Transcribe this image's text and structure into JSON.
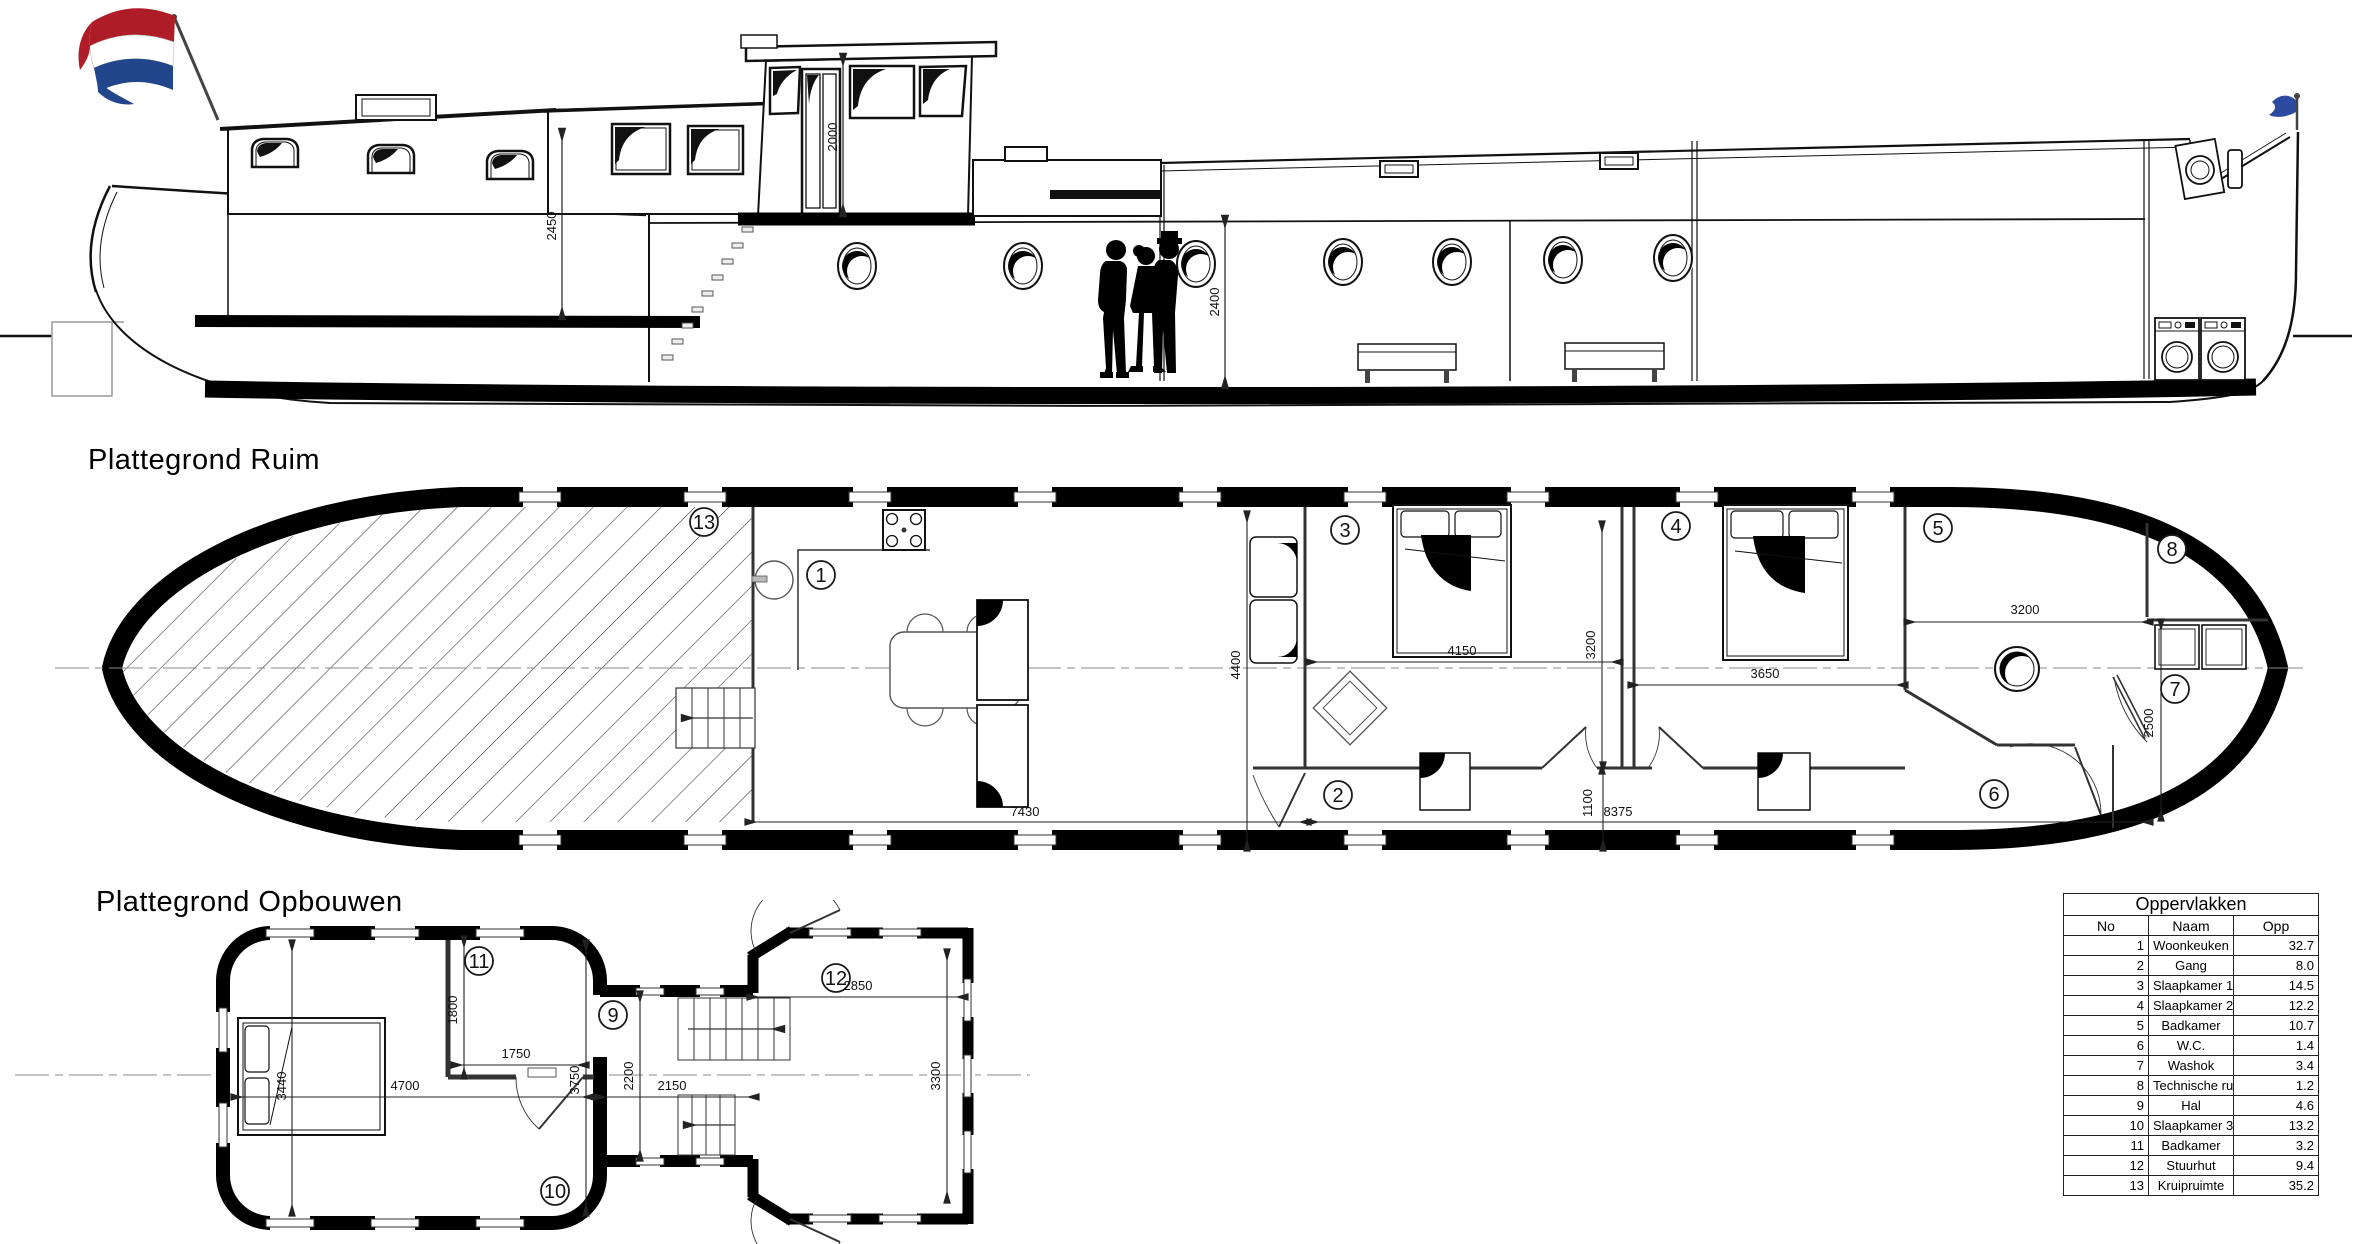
{
  "titles": {
    "ruim": "Plattegrond Ruim",
    "opbouwen": "Plattegrond Opbouwen"
  },
  "table": {
    "title": "Oppervlakken",
    "columns": [
      "No",
      "Naam",
      "Opp"
    ],
    "rows": [
      [
        "1",
        "Woonkeuken",
        "32.7"
      ],
      [
        "2",
        "Gang",
        "8.0"
      ],
      [
        "3",
        "Slaapkamer 1",
        "14.5"
      ],
      [
        "4",
        "Slaapkamer 2",
        "12.2"
      ],
      [
        "5",
        "Badkamer",
        "10.7"
      ],
      [
        "6",
        "W.C.",
        "1.4"
      ],
      [
        "7",
        "Washok",
        "3.4"
      ],
      [
        "8",
        "Technische ruimte",
        "1.2"
      ],
      [
        "9",
        "Hal",
        "4.6"
      ],
      [
        "10",
        "Slaapkamer 3",
        "13.2"
      ],
      [
        "11",
        "Badkamer",
        "3.2"
      ],
      [
        "12",
        "Stuurhut",
        "9.4"
      ],
      [
        "13",
        "Kruipruimte",
        "35.2"
      ]
    ]
  },
  "markers": {
    "m1": "1",
    "m2": "2",
    "m3": "3",
    "m4": "4",
    "m5": "5",
    "m6": "6",
    "m7": "7",
    "m8": "8",
    "m9": "9",
    "m10": "10",
    "m11": "11",
    "m12": "12",
    "m13": "13"
  },
  "dims": {
    "elev_fore_height": "2450",
    "elev_wheelhouse_height": "2000",
    "elev_hold_height": "2400",
    "ruim_woonkeuken_w": "7430",
    "ruim_beam": "4400",
    "ruim_slaapkamer1_w": "4150",
    "ruim_slaapkamer1_d": "3200",
    "ruim_slaapkamer2_w": "3650",
    "ruim_gang_l": "8375",
    "ruim_gang_w": "1100",
    "ruim_badkamer_w": "3200",
    "ruim_washok_d": "2500",
    "opb_slaapkamer3_d": "3440",
    "opb_slaapkamer3_w": "4700",
    "opb_badkamer_d": "1800",
    "opb_badkamer_w": "1750",
    "opb_cabin_d": "3750",
    "opb_hal_d": "2200",
    "opb_hal_w": "2150",
    "opb_stuurhut_w": "2850",
    "opb_stuurhut_d": "3300"
  },
  "flag": {
    "red": "#AE1C28",
    "white": "#FFFFFF",
    "blue": "#21468B",
    "stern_blue": "#2C4BA0"
  }
}
